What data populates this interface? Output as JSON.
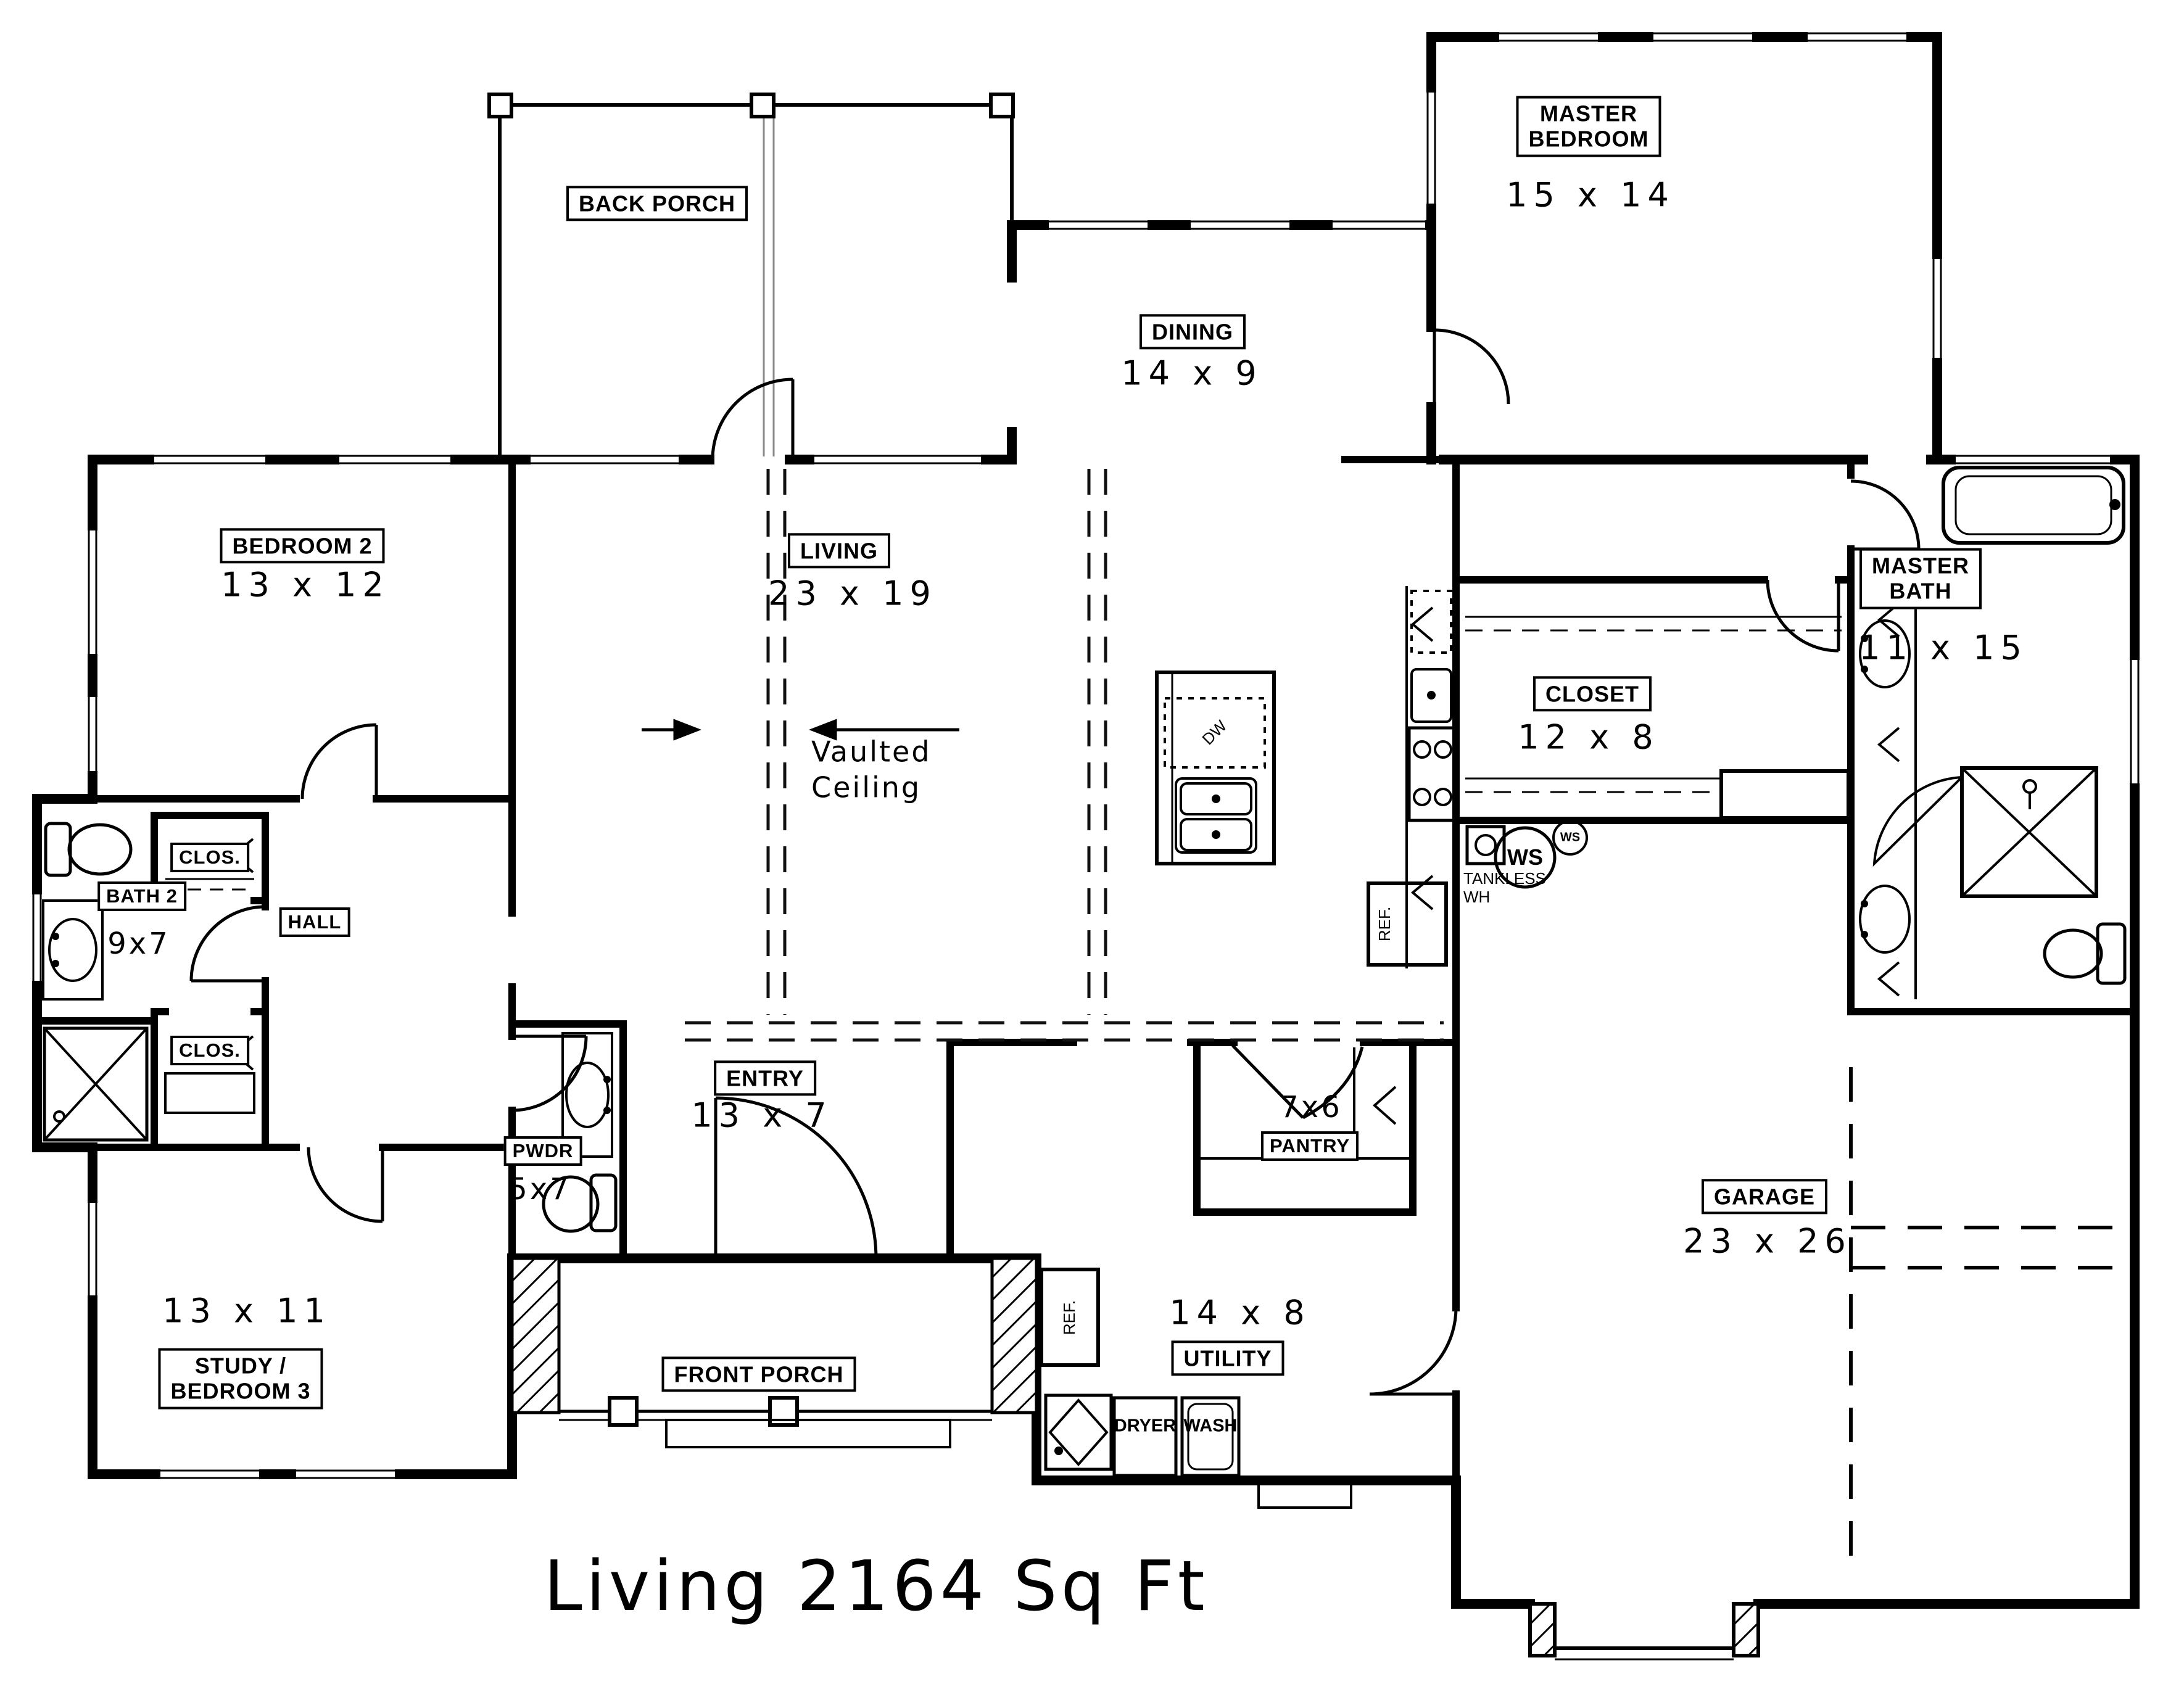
{
  "title": "Living 2164 Sq Ft",
  "rooms": {
    "back_porch": {
      "name": "BACK PORCH"
    },
    "master_bedroom": {
      "name": "MASTER\nBEDROOM",
      "dims": "15 x 14"
    },
    "dining": {
      "name": "DINING",
      "dims": "14 x 9"
    },
    "living": {
      "name": "LIVING",
      "dims": "23 x 19",
      "note": "Vaulted\nCeiling"
    },
    "bedroom2": {
      "name": "BEDROOM 2",
      "dims": "13 x 12"
    },
    "master_bath": {
      "name": "MASTER\nBATH",
      "dims": "11 x 15"
    },
    "closet": {
      "name": "CLOSET",
      "dims": "12 x 8"
    },
    "bath2": {
      "name": "BATH 2",
      "dims": "9x7"
    },
    "closet_top": {
      "name": "CLOS."
    },
    "closet_bottom": {
      "name": "CLOS."
    },
    "hall": {
      "name": "HALL"
    },
    "study": {
      "name": "STUDY /\nBEDROOM 3",
      "dims": "13 x 11"
    },
    "pwdr": {
      "name": "PWDR",
      "dims": "5x7"
    },
    "entry": {
      "name": "ENTRY",
      "dims": "13 x 7"
    },
    "front_porch": {
      "name": "FRONT PORCH"
    },
    "pantry": {
      "name": "PANTRY",
      "dims": "7x6"
    },
    "utility": {
      "name": "UTILITY",
      "dims": "14 x 8"
    },
    "garage": {
      "name": "GARAGE",
      "dims": "23 x 26"
    }
  },
  "equipment": {
    "tankless": "TANKLESS\nWH",
    "ws_large": "WS",
    "ws_small": "WS",
    "dryer": "DRYER",
    "washer": "WASH",
    "ref_kitchen": "REF.",
    "ref_utility": "REF.",
    "dishwasher": "DW"
  }
}
